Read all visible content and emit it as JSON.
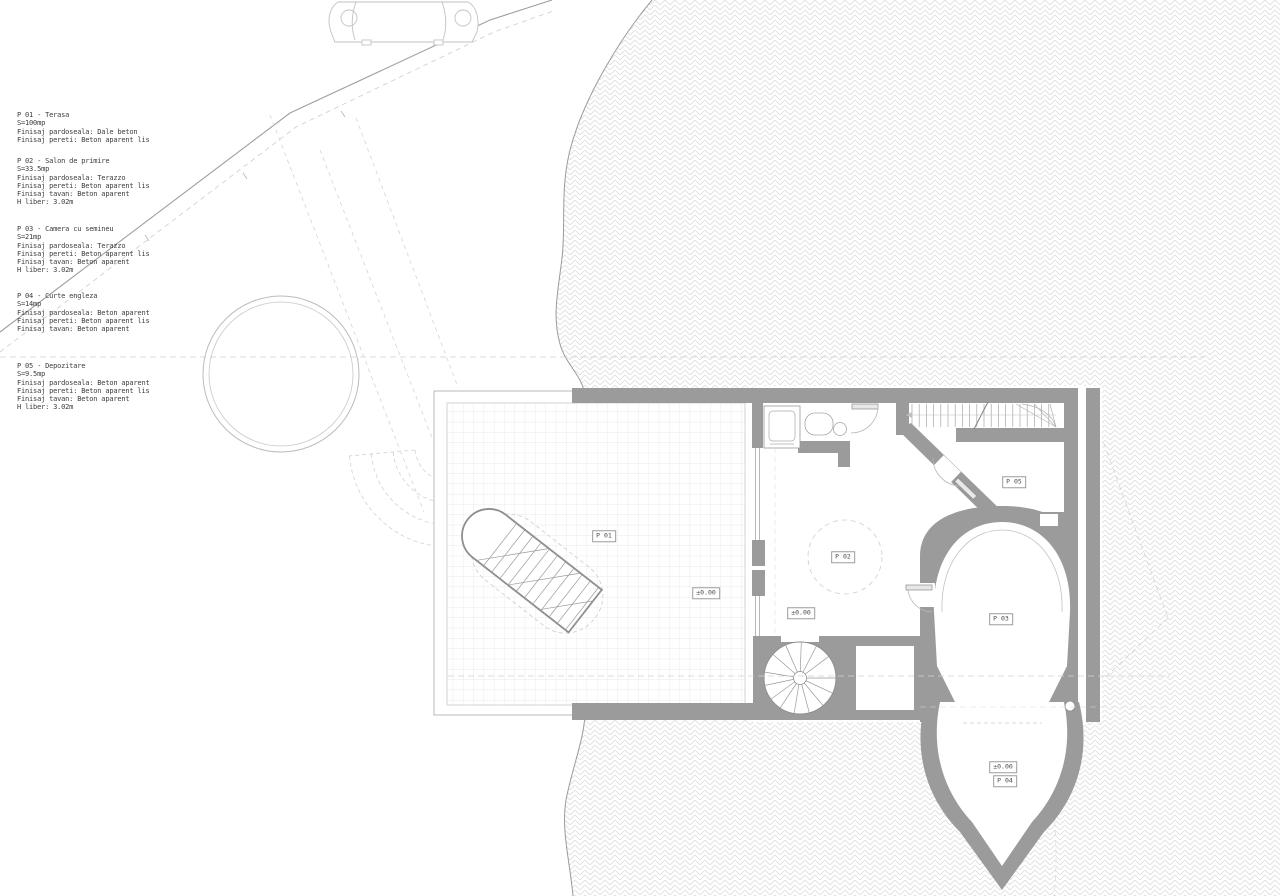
{
  "document": {
    "type": "architectural-ground-floor-plan",
    "language": "Romanian"
  },
  "legend": {
    "rooms": [
      {
        "id": "P 01",
        "name": "Terasa",
        "area": "S=100mp",
        "finishes": [
          "Finisaj pardoseala: Dale beton",
          "Finisaj pereti: Beton aparent lis"
        ]
      },
      {
        "id": "P 02",
        "name": "Salon de primire",
        "area": "S=33.5mp",
        "finishes": [
          "Finisaj pardoseala: Terazzo",
          "Finisaj pereti: Beton aparent lis",
          "Finisaj tavan: Beton aparent",
          "H liber: 3.02m"
        ]
      },
      {
        "id": "P 03",
        "name": "Camera cu semineu",
        "area": "S=21mp",
        "finishes": [
          "Finisaj pardoseala: Terazzo",
          "Finisaj pereti: Beton aparent lis",
          "Finisaj tavan: Beton aparent",
          "H liber: 3.02m"
        ]
      },
      {
        "id": "P 04",
        "name": "Curte engleza",
        "area": "S=14mp",
        "finishes": [
          "Finisaj pardoseala: Beton aparent",
          "Finisaj pereti: Beton aparent lis",
          "Finisaj tavan: Beton aparent"
        ]
      },
      {
        "id": "P 05",
        "name": "Depozitare",
        "area": "S=9.5mp",
        "finishes": [
          "Finisaj pardoseala: Beton aparent",
          "Finisaj pereti: Beton aparent lis",
          "Finisaj tavan: Beton aparent",
          "H liber: 3.02m"
        ]
      }
    ]
  },
  "plan": {
    "labels": [
      {
        "key": "p01",
        "text": "P 01",
        "x": 604,
        "y": 536
      },
      {
        "key": "terrace-level",
        "text": "±0.00",
        "x": 706,
        "y": 593
      },
      {
        "key": "p02",
        "text": "P 02",
        "x": 843,
        "y": 557
      },
      {
        "key": "p02-level",
        "text": "±0.00",
        "x": 801,
        "y": 613
      },
      {
        "key": "p05",
        "text": "P 05",
        "x": 1014,
        "y": 482
      },
      {
        "key": "p03",
        "text": "P 03",
        "x": 1001,
        "y": 619
      },
      {
        "key": "p04-level",
        "text": "±0.00",
        "x": 1003,
        "y": 767
      },
      {
        "key": "p04",
        "text": "P 04",
        "x": 1005,
        "y": 781
      }
    ]
  },
  "icons": {
    "car": "car-icon",
    "spiral_stair": "spiral-stair-icon",
    "straight_stair": "straight-stair-icon",
    "exterior_stair": "exterior-stair-icon",
    "bathtub": "bathtub-icon",
    "sink": "sink-icon"
  },
  "colors": {
    "wall_gray": "#9b9b9b",
    "thin_line_gray": "#a8a8a8",
    "dashed_line_gray": "#cfcfcf",
    "hatch_line_gray": "#dcdcdc",
    "tile_line_gray": "#e3e3e3",
    "text_gray": "#3d3d3d",
    "background": "#ffffff"
  }
}
